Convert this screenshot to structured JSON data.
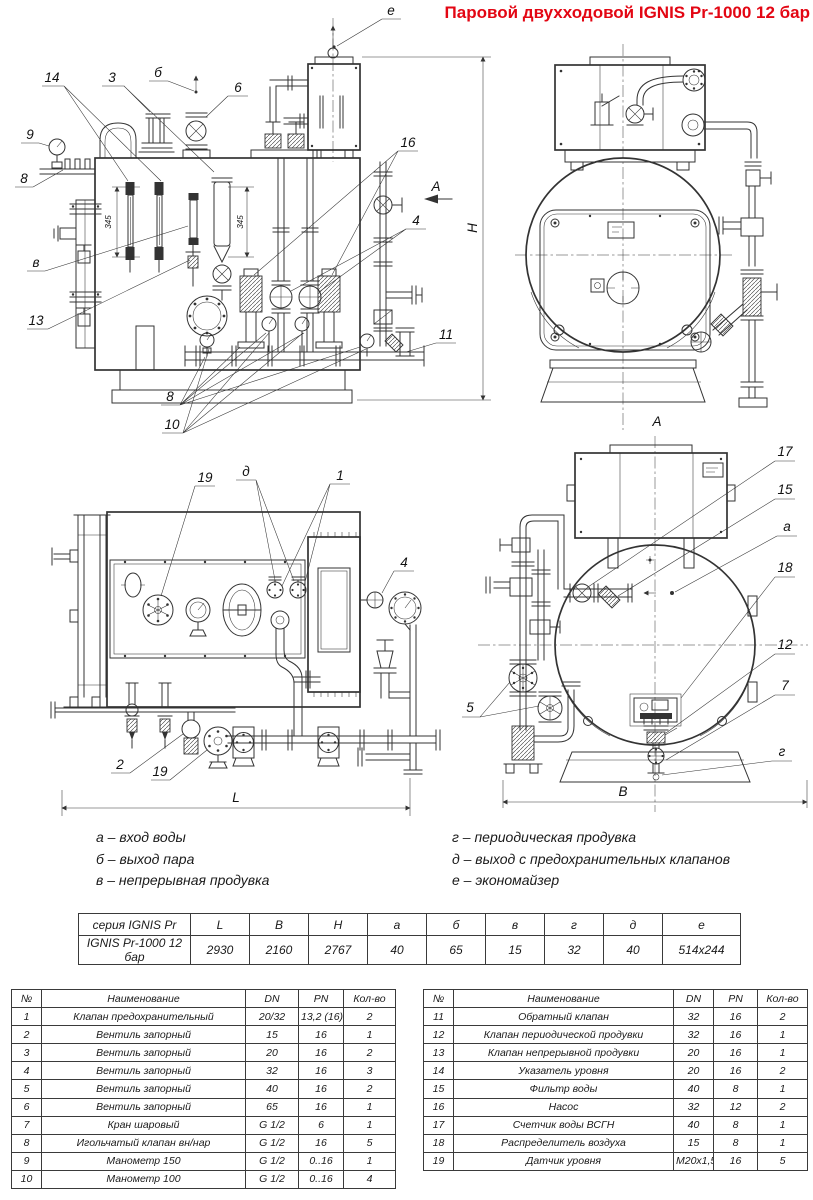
{
  "title": "Паровой двухходовой IGNIS Pr-1000 12 бар",
  "colors": {
    "title_red": "#e30613",
    "line": "#333333"
  },
  "callouts": {
    "v1": {
      "n14": "14",
      "n3": "3",
      "b": "б",
      "n6": "6",
      "e": "е",
      "n9": "9",
      "n8": "8",
      "v": "в",
      "n13": "13",
      "n8b": "8",
      "n10": "10",
      "n16": "16",
      "n4": "4",
      "n11": "11",
      "view_a": "А",
      "dim_h": "H",
      "dim345": "345"
    },
    "v2": {
      "view_label": "А"
    },
    "v3": {
      "n19": "19",
      "d": "д",
      "n1": "1",
      "n4": "4",
      "n2": "2",
      "n19b": "19",
      "dim_l": "L"
    },
    "v4": {
      "n17": "17",
      "n15": "15",
      "a": "а",
      "n18": "18",
      "n12": "12",
      "n7": "7",
      "g": "г",
      "n5": "5",
      "dim_b": "В"
    }
  },
  "legend": {
    "left": [
      "а – вход воды",
      "б – выход пара",
      "в – непрерывная продувка"
    ],
    "right": [
      "г – периодическая продувка",
      "д – выход с предохранительных клапанов",
      "е – экономайзер"
    ]
  },
  "tables": {
    "dims": {
      "headers": [
        "серия IGNIS Pr",
        "L",
        "B",
        "H",
        "а",
        "б",
        "в",
        "г",
        "д",
        "е"
      ],
      "rows": [
        [
          "IGNIS Pr-1000 12 бар",
          "2930",
          "2160",
          "2767",
          "40",
          "65",
          "15",
          "32",
          "40",
          "514x244"
        ]
      ]
    },
    "parts_left": {
      "headers": [
        "№",
        "Наименование",
        "DN",
        "PN",
        "Кол-во"
      ],
      "rows": [
        [
          "1",
          "Клапан предохранительный",
          "20/32",
          "13,2 (16)",
          "2"
        ],
        [
          "2",
          "Вентиль запорный",
          "15",
          "16",
          "1"
        ],
        [
          "3",
          "Вентиль запорный",
          "20",
          "16",
          "2"
        ],
        [
          "4",
          "Вентиль запорный",
          "32",
          "16",
          "3"
        ],
        [
          "5",
          "Вентиль запорный",
          "40",
          "16",
          "2"
        ],
        [
          "6",
          "Вентиль запорный",
          "65",
          "16",
          "1"
        ],
        [
          "7",
          "Кран шаровый",
          "G 1/2",
          "6",
          "1"
        ],
        [
          "8",
          "Игольчатый клапан вн/нар",
          "G 1/2",
          "16",
          "5"
        ],
        [
          "9",
          "Манометр 150",
          "G 1/2",
          "0..16",
          "1"
        ],
        [
          "10",
          "Манометр 100",
          "G 1/2",
          "0..16",
          "4"
        ]
      ]
    },
    "parts_right": {
      "headers": [
        "№",
        "Наименование",
        "DN",
        "PN",
        "Кол-во"
      ],
      "rows": [
        [
          "11",
          "Обратный клапан",
          "32",
          "16",
          "2"
        ],
        [
          "12",
          "Клапан периодической продувки",
          "32",
          "16",
          "1"
        ],
        [
          "13",
          "Клапан непрерывной продувки",
          "20",
          "16",
          "1"
        ],
        [
          "14",
          "Указатель уровня",
          "20",
          "16",
          "2"
        ],
        [
          "15",
          "Фильтр воды",
          "40",
          "8",
          "1"
        ],
        [
          "16",
          "Насос",
          "32",
          "12",
          "2"
        ],
        [
          "17",
          "Счетчик воды ВСГН",
          "40",
          "8",
          "1"
        ],
        [
          "18",
          "Распределитель воздуха",
          "15",
          "8",
          "1"
        ],
        [
          "19",
          "Датчик уровня",
          "M20x1,5",
          "16",
          "5"
        ]
      ]
    }
  }
}
